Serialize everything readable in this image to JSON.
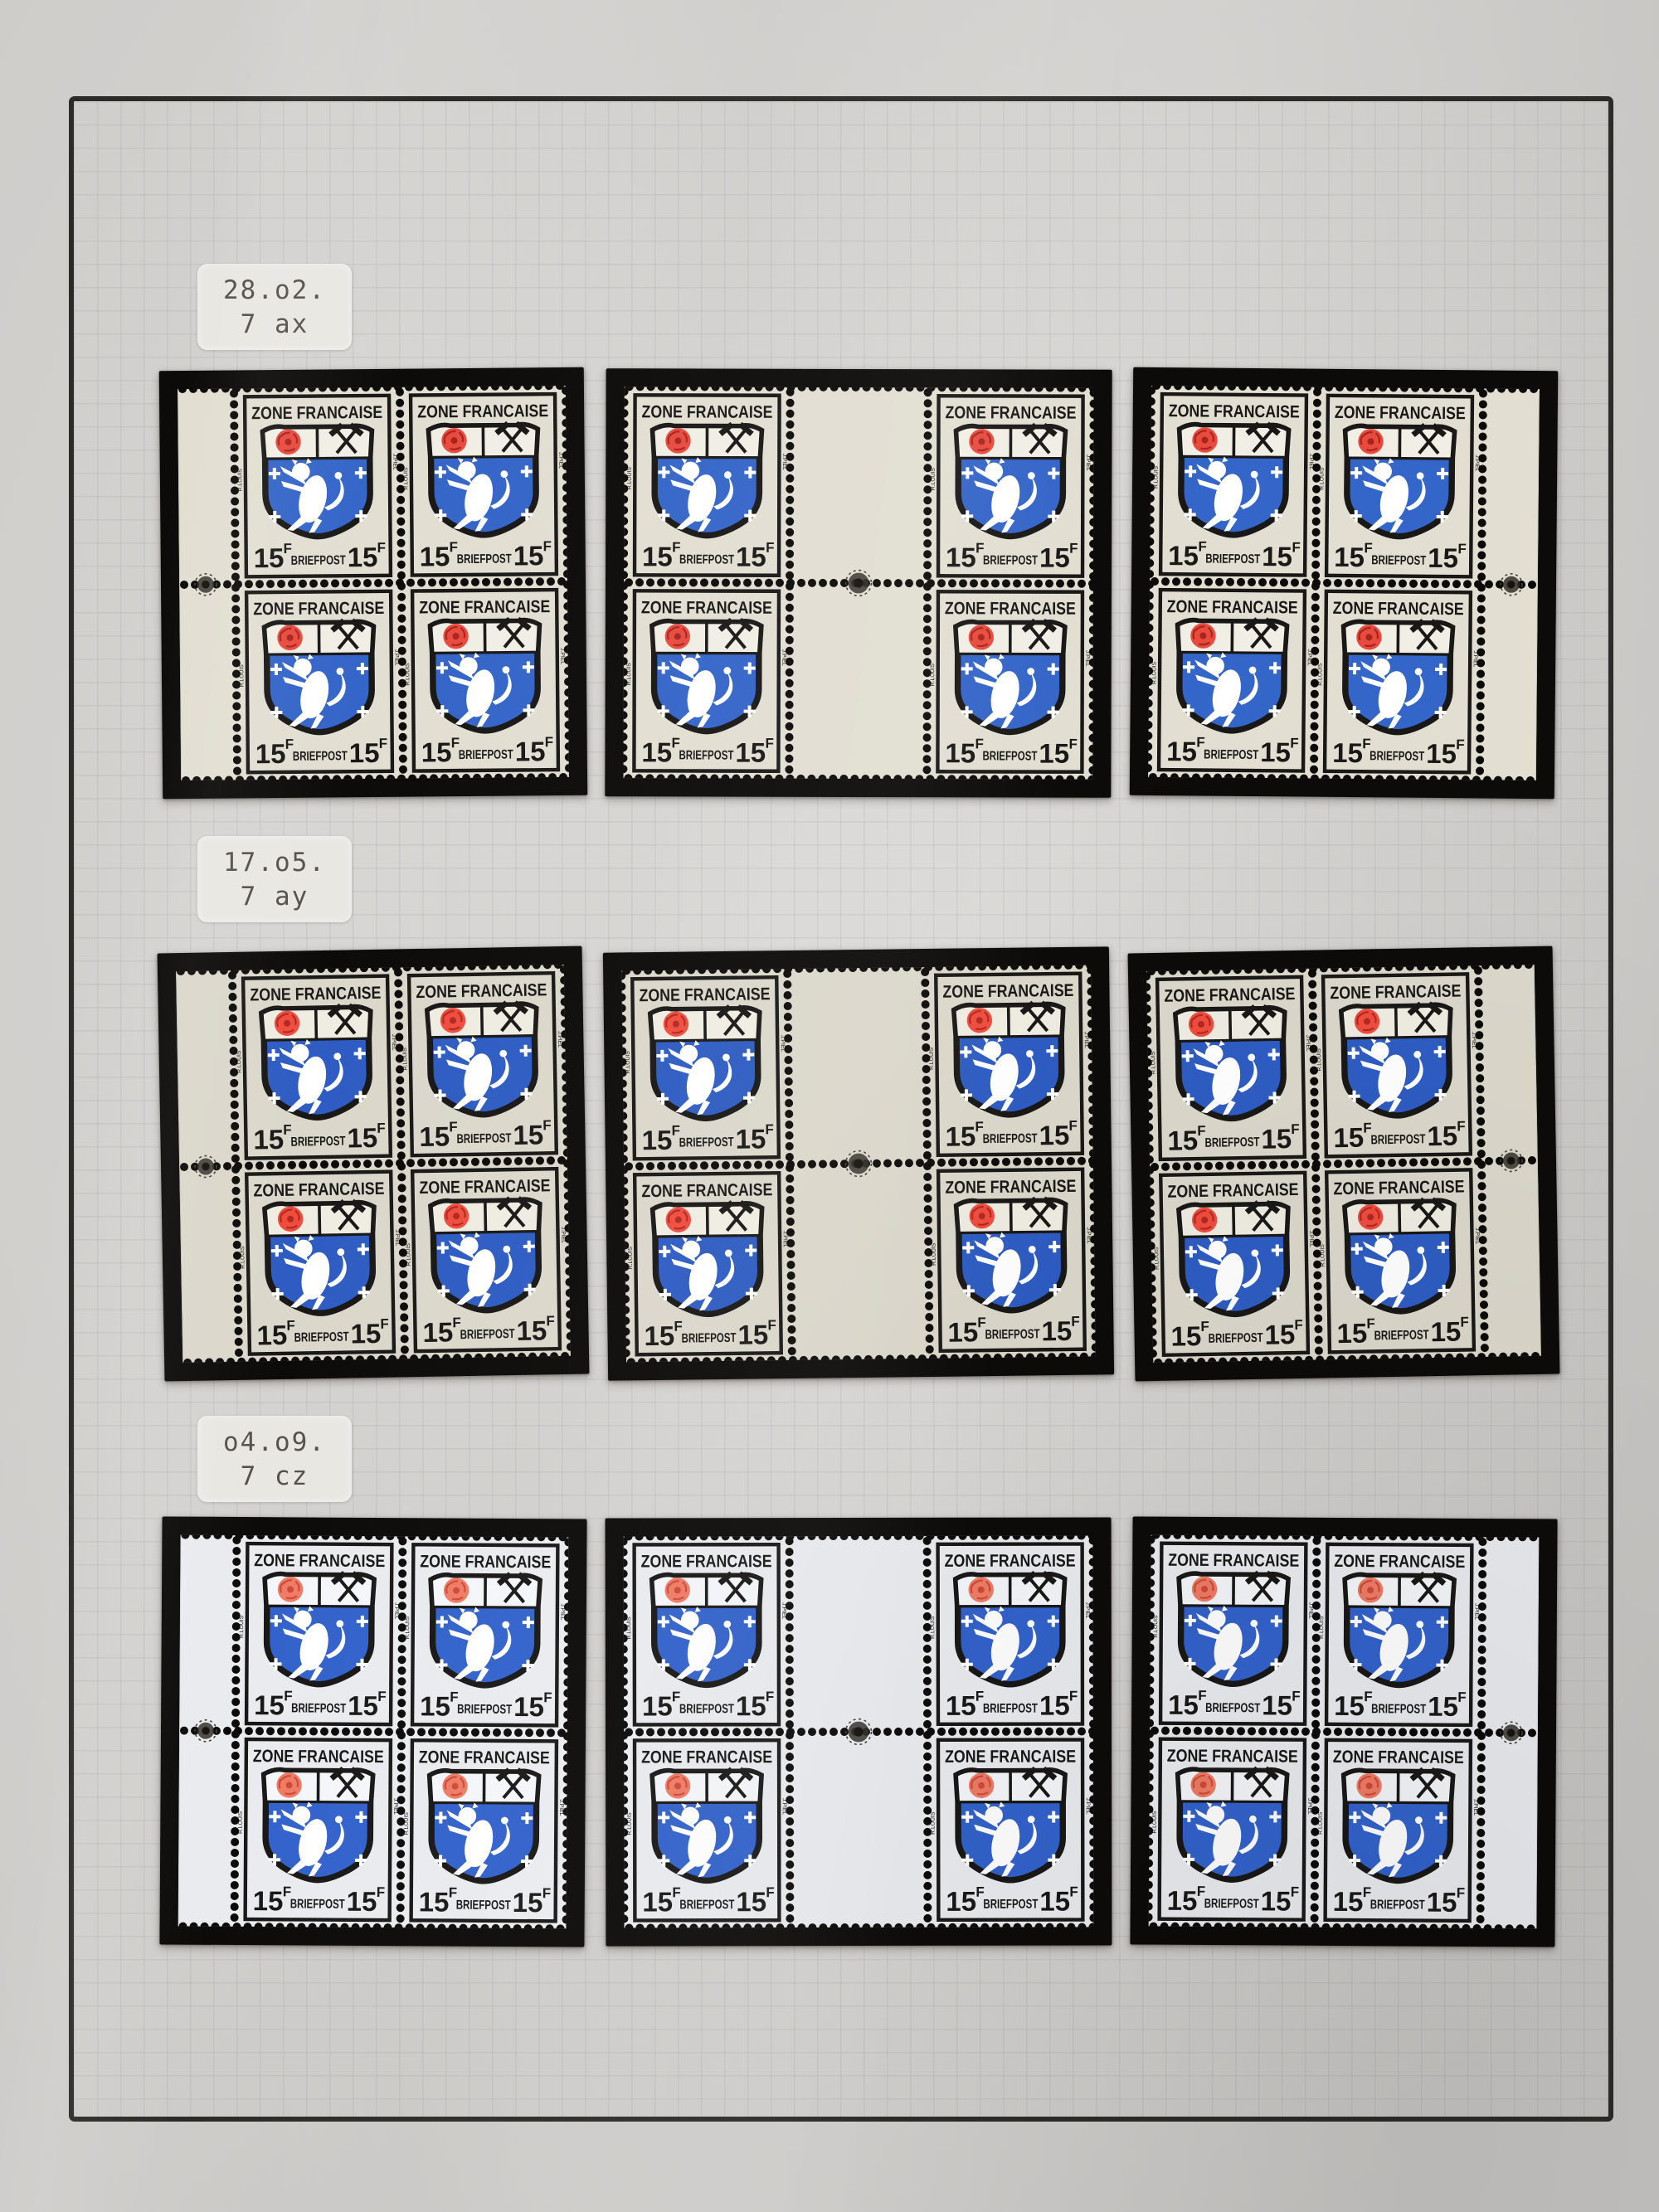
{
  "page": {
    "background": "#d8d6d3",
    "frame_color": "#2c2b28",
    "grid_color": "rgba(120,126,142,0.13)",
    "mount_color": "#0c0b09",
    "label_bg": "#e9e7e2",
    "label_text_color": "#56524b"
  },
  "stamp": {
    "country_text": "ZONE FRANCAISE",
    "denomination": "15",
    "denomination_unit": "F",
    "service_text": "BRIEFPOST",
    "designer_credit_left": "R.LOUIS",
    "designer_credit_right": "J.PIEL",
    "ink_color": "#191817"
  },
  "rows": [
    {
      "label": {
        "line1": "28.o2.",
        "line2": "7 ax"
      },
      "paper": "#e2ded2",
      "chief": "#f1eee5",
      "rose": "#e84a3e",
      "rose_detail": "#a8251d",
      "blue": "#3465c8",
      "mounts": [
        "block4-margin-left",
        "gutter-block",
        "block4-margin-right"
      ]
    },
    {
      "label": {
        "line1": "17.o5.",
        "line2": "7 ay"
      },
      "paper": "#dbd7cb",
      "chief": "#efece2",
      "rose": "#f04c3e",
      "rose_detail": "#b02a20",
      "blue": "#2e5cc2",
      "mounts": [
        "block4-margin-left",
        "gutter-block",
        "block4-margin-right"
      ]
    },
    {
      "label": {
        "line1": "o4.o9.",
        "line2": "7 cz"
      },
      "paper": "#e9ebef",
      "chief": "#f4f6f9",
      "rose": "#ee7c66",
      "rose_detail": "#cf4a36",
      "blue": "#3262cb",
      "mounts": [
        "block4-margin-left",
        "gutter-block",
        "block4-margin-right"
      ]
    }
  ]
}
